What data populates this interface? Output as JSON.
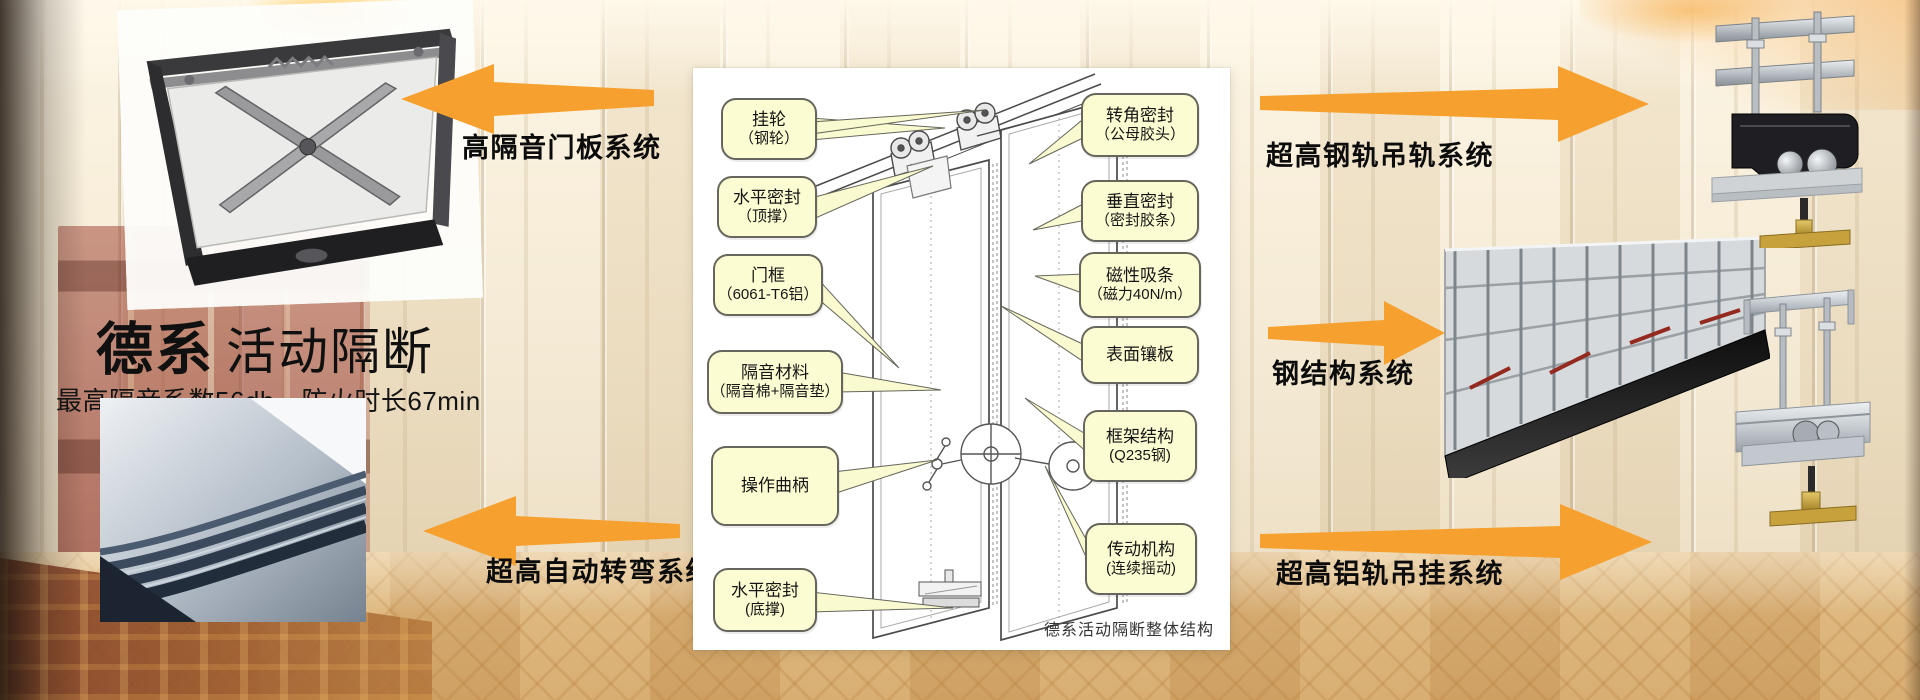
{
  "page": {
    "title_brand": "德系",
    "title_rest": "活动隔断",
    "subtitle": "最高隔音系数56db，防火时长67min"
  },
  "systems": {
    "left_top": "高隔音门板系统",
    "left_bottom": "超高自动转弯系统",
    "right_top": "超高钢轨吊轨系统",
    "right_mid": "钢结构系统",
    "right_bottom": "超高铝轨吊挂系统"
  },
  "diagram": {
    "caption": "德系活动隔断整体结构",
    "left_labels": [
      {
        "line1": "挂轮",
        "line2": "（钢轮）"
      },
      {
        "line1": "水平密封",
        "line2": "（顶撑）"
      },
      {
        "line1": "门框",
        "line2": "（6061-T6铝）"
      },
      {
        "line1": "隔音材料",
        "line2": "（隔音棉+隔音垫）"
      },
      {
        "line1": "操作曲柄",
        "line2": ""
      },
      {
        "line1": "水平密封",
        "line2": "(底撑)"
      }
    ],
    "right_labels": [
      {
        "line1": "转角密封",
        "line2": "（公母胶头）"
      },
      {
        "line1": "垂直密封",
        "line2": "（密封胶条）"
      },
      {
        "line1": "磁性吸条",
        "line2": "（磁力40N/m）"
      },
      {
        "line1": "表面镶板",
        "line2": ""
      },
      {
        "line1": "框架结构",
        "line2": "(Q235钢)"
      },
      {
        "line1": "传动机构",
        "line2": "(连续摇动)"
      }
    ]
  },
  "colors": {
    "arrow_orange": "#F6A12F",
    "callout_fill": "#FCFCD2",
    "callout_border": "#66665C",
    "title_text": "#101010",
    "panel_background": "#FFFFFF"
  }
}
